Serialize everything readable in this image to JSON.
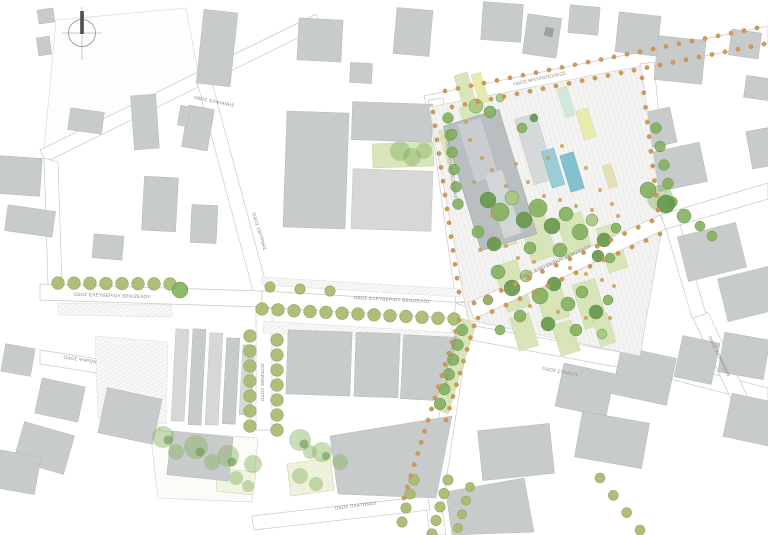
{
  "drawing": {
    "kind": "urban masterplan site plan",
    "plaza": "central pedestrian square with tree groves, planting beds and two water pools"
  },
  "streets": {
    "sofianis": {
      "label": "ΟΔΟΣ ΣΟΦΙΑΝΗΣ"
    },
    "venizelou_left": {
      "label": "ΟΔΟΣ ΕΛΕΥΘΕΡΙΟΥ ΒΕΝΙΖΕΛΟΥ"
    },
    "venizelou_mid": {
      "label": "ΟΔΟΣ ΕΛΕΥΘΕΡΙΟΥ ΒΕΝΙΖΕΛΟΥ"
    },
    "venizelou_plaza": {
      "label": "ΟΔΟΣ ΕΛΕΥΘΕΡΙΟΥ ΒΕΝΙΖΕΛΟΥ"
    },
    "mitropoleos": {
      "label": "ΟΔΟΣ ΜΗΤΡΟΠΟΛΕΩΣ"
    },
    "agias_theodoras": {
      "label": "ΟΔΟΣ ΑΓΙΑΣ ΘΕΟΔΩΡΑΣ"
    },
    "smyrnis": {
      "label": "ΟΔΟΣ ΣΜΥΡΝΗΣ"
    },
    "themidos": {
      "label": "ΟΔΟΣ ΘΕΜΙΔΟΣ"
    },
    "psaron": {
      "label": "ΟΔΟΣ ΨΑΡΩΝ"
    },
    "platonos": {
      "label": "ΟΔΟΣ ΠΛΑΤΩΝΟΣ"
    },
    "stadiou": {
      "label": "ΟΔΟΣ ΣΤΑΔΙΟΥ"
    },
    "komninon": {
      "label": "ΟΔΟΣ ΚΟΜΝΗΝΩΝ"
    },
    "agiou_georgiou": {
      "label": "ΟΔΟΣ ΑΓΙΟΥ ΓΕΩΡΓΙΟΥ"
    }
  },
  "palette": {
    "building": "#c8cbcb",
    "building_light": "#d6d8d8",
    "building_dark": "#9da1a1",
    "plaza_building": "#b9bec0",
    "water_light": "#9ccdd6",
    "water": "#83c1cf",
    "tree_dark": "#69994d",
    "tree_mid": "#86b260",
    "tree_light": "#a9c87f",
    "street_tree": "#a9bc72",
    "street_tree_edge": "#8ea25a",
    "orange_dot": "#cf9a55",
    "bed_green": "#d9e5ba",
    "bed_yellow": "#e9ebad",
    "bed_tan": "#e6dfb6",
    "bed_blue": "#d2e7de",
    "road_edge": "#c9c9c9",
    "label": "#858585"
  }
}
